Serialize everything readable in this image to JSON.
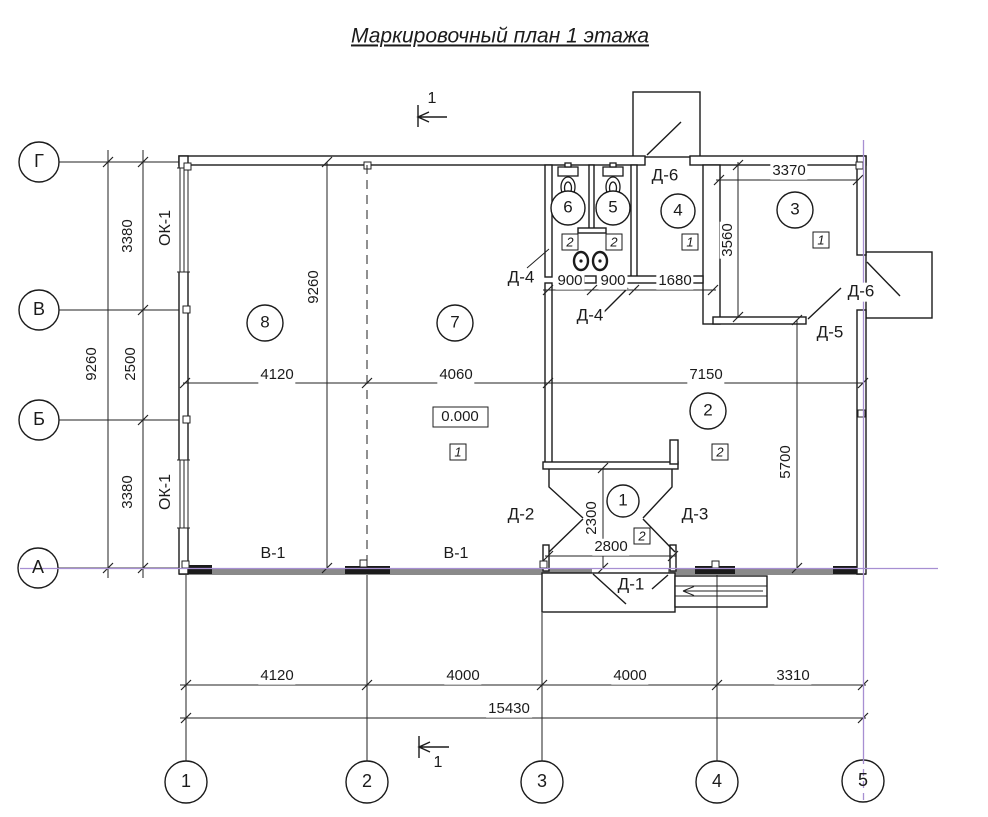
{
  "colors": {
    "line": "#1b1b1b",
    "axis_accent": "#a78fd2",
    "wall_gray": "#8a8a8a"
  },
  "labels": [
    {
      "name": "drawing-title",
      "text": "Маркировочный план 1 этажа",
      "x": 500,
      "y": 36,
      "cls": "title"
    },
    {
      "name": "axis-row-g",
      "text": "Г",
      "x": 39,
      "y": 162,
      "cls": "axis"
    },
    {
      "name": "axis-row-v",
      "text": "В",
      "x": 39,
      "y": 310,
      "cls": "axis"
    },
    {
      "name": "axis-row-b",
      "text": "Б",
      "x": 39,
      "y": 420,
      "cls": "axis"
    },
    {
      "name": "axis-row-a",
      "text": "А",
      "x": 38,
      "y": 568,
      "cls": "axis"
    },
    {
      "name": "axis-col-1",
      "text": "1",
      "x": 186,
      "y": 782,
      "cls": "axis"
    },
    {
      "name": "axis-col-2",
      "text": "2",
      "x": 367,
      "y": 782,
      "cls": "axis"
    },
    {
      "name": "axis-col-3",
      "text": "3",
      "x": 542,
      "y": 782,
      "cls": "axis"
    },
    {
      "name": "axis-col-4",
      "text": "4",
      "x": 717,
      "y": 782,
      "cls": "axis"
    },
    {
      "name": "axis-col-5",
      "text": "5",
      "x": 863,
      "y": 781,
      "cls": "axis"
    },
    {
      "name": "dim-left-3380-top",
      "text": "3380",
      "x": 128,
      "y": 236,
      "cls": "dim rot"
    },
    {
      "name": "dim-left-2500",
      "text": "2500",
      "x": 131,
      "y": 364,
      "cls": "dim rot"
    },
    {
      "name": "dim-left-3380-bottom",
      "text": "3380",
      "x": 128,
      "y": 492,
      "cls": "dim rot"
    },
    {
      "name": "dim-left-9260",
      "text": "9260",
      "x": 92,
      "y": 364,
      "cls": "dim rot"
    },
    {
      "name": "dim-inner-9260",
      "text": "9260",
      "x": 314,
      "y": 287,
      "cls": "dim rot"
    },
    {
      "name": "dim-inner-4120",
      "text": "4120",
      "x": 277,
      "y": 375,
      "cls": "dim"
    },
    {
      "name": "dim-inner-4060",
      "text": "4060",
      "x": 456,
      "y": 375,
      "cls": "dim"
    },
    {
      "name": "dim-inner-7150",
      "text": "7150",
      "x": 706,
      "y": 375,
      "cls": "dim"
    },
    {
      "name": "dim-wc-900-left",
      "text": "900",
      "x": 570,
      "y": 281,
      "cls": "dim"
    },
    {
      "name": "dim-wc-900-right",
      "text": "900",
      "x": 613,
      "y": 281,
      "cls": "dim"
    },
    {
      "name": "dim-wc-1680",
      "text": "1680",
      "x": 675,
      "y": 281,
      "cls": "dim"
    },
    {
      "name": "dim-room3-3370",
      "text": "3370",
      "x": 789,
      "y": 171,
      "cls": "dim"
    },
    {
      "name": "dim-room3-3560",
      "text": "3560",
      "x": 728,
      "y": 240,
      "cls": "dim rot"
    },
    {
      "name": "dim-room2-5700",
      "text": "5700",
      "x": 786,
      "y": 462,
      "cls": "dim rot"
    },
    {
      "name": "dim-tambour-2300",
      "text": "2300",
      "x": 592,
      "y": 518,
      "cls": "dim rot"
    },
    {
      "name": "dim-tambour-2800",
      "text": "2800",
      "x": 611,
      "y": 547,
      "cls": "dim"
    },
    {
      "name": "dim-bottom-4120",
      "text": "4120",
      "x": 277,
      "y": 676,
      "cls": "dim"
    },
    {
      "name": "dim-bottom-4000-left",
      "text": "4000",
      "x": 463,
      "y": 676,
      "cls": "dim"
    },
    {
      "name": "dim-bottom-4000-right",
      "text": "4000",
      "x": 630,
      "y": 676,
      "cls": "dim"
    },
    {
      "name": "dim-bottom-3310",
      "text": "3310",
      "x": 793,
      "y": 676,
      "cls": "dim"
    },
    {
      "name": "dim-bottom-15430",
      "text": "15430",
      "x": 509,
      "y": 709,
      "cls": "dim"
    },
    {
      "name": "room-number-8",
      "text": "8",
      "x": 265,
      "y": 323,
      "cls": "room"
    },
    {
      "name": "room-number-7",
      "text": "7",
      "x": 455,
      "y": 323,
      "cls": "room"
    },
    {
      "name": "room-number-6",
      "text": "6",
      "x": 568,
      "y": 208,
      "cls": "room"
    },
    {
      "name": "room-number-5",
      "text": "5",
      "x": 613,
      "y": 208,
      "cls": "room"
    },
    {
      "name": "room-number-4",
      "text": "4",
      "x": 678,
      "y": 211,
      "cls": "room"
    },
    {
      "name": "room-number-3",
      "text": "3",
      "x": 795,
      "y": 210,
      "cls": "room"
    },
    {
      "name": "room-number-2",
      "text": "2",
      "x": 708,
      "y": 411,
      "cls": "room"
    },
    {
      "name": "room-number-1",
      "text": "1",
      "x": 623,
      "y": 501,
      "cls": "room"
    },
    {
      "name": "floor-type-wc6",
      "text": "2",
      "x": 570,
      "y": 242,
      "cls": "sq"
    },
    {
      "name": "floor-type-wc5",
      "text": "2",
      "x": 614,
      "y": 242,
      "cls": "sq"
    },
    {
      "name": "floor-type-room4",
      "text": "1",
      "x": 690,
      "y": 242,
      "cls": "sq"
    },
    {
      "name": "floor-type-room3",
      "text": "1",
      "x": 821,
      "y": 240,
      "cls": "sq"
    },
    {
      "name": "floor-type-room7",
      "text": "1",
      "x": 458,
      "y": 452,
      "cls": "sq"
    },
    {
      "name": "floor-type-room2",
      "text": "2",
      "x": 720,
      "y": 452,
      "cls": "sq"
    },
    {
      "name": "floor-type-room1",
      "text": "2",
      "x": 642,
      "y": 536,
      "cls": "sq"
    },
    {
      "name": "level-mark",
      "text": "0.000",
      "x": 460,
      "y": 417,
      "cls": "lvl"
    },
    {
      "name": "door-label-d6-top",
      "text": "Д-6",
      "x": 665,
      "y": 176,
      "cls": "door"
    },
    {
      "name": "door-label-d4-left",
      "text": "Д-4",
      "x": 521,
      "y": 278,
      "cls": "door"
    },
    {
      "name": "door-label-d4-bottom",
      "text": "Д-4",
      "x": 590,
      "y": 316,
      "cls": "door"
    },
    {
      "name": "door-label-d6-right",
      "text": "Д-6",
      "x": 861,
      "y": 292,
      "cls": "door"
    },
    {
      "name": "door-label-d5",
      "text": "Д-5",
      "x": 830,
      "y": 333,
      "cls": "door"
    },
    {
      "name": "door-label-d2",
      "text": "Д-2",
      "x": 521,
      "y": 515,
      "cls": "door"
    },
    {
      "name": "door-label-d3",
      "text": "Д-3",
      "x": 695,
      "y": 515,
      "cls": "door"
    },
    {
      "name": "door-label-d1",
      "text": "Д-1",
      "x": 631,
      "y": 585,
      "cls": "door"
    },
    {
      "name": "window-label-ok1-top",
      "text": "ОК-1",
      "x": 166,
      "y": 228,
      "cls": "win rot"
    },
    {
      "name": "window-label-ok1-bottom",
      "text": "ОК-1",
      "x": 166,
      "y": 492,
      "cls": "win rot"
    },
    {
      "name": "window-label-v1-left",
      "text": "В-1",
      "x": 273,
      "y": 554,
      "cls": "win"
    },
    {
      "name": "window-label-v1-right",
      "text": "В-1",
      "x": 456,
      "y": 554,
      "cls": "win"
    },
    {
      "name": "section-mark-label-top",
      "text": "1",
      "x": 432,
      "y": 99,
      "cls": "sec"
    },
    {
      "name": "section-mark-label-bottom",
      "text": "1",
      "x": 438,
      "y": 763,
      "cls": "sec"
    }
  ]
}
